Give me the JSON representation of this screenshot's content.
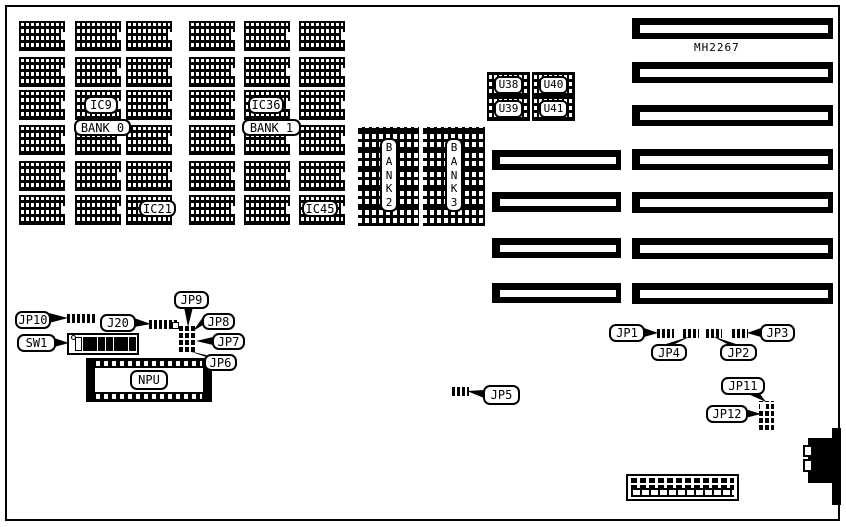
{
  "board": {
    "part_number": "MH2267",
    "chip_grid": {
      "cols": [
        19,
        75,
        126,
        189,
        244,
        299
      ],
      "rows": [
        21,
        57,
        90,
        125,
        161,
        195
      ],
      "chip_w": 46,
      "chip_h": 30
    },
    "chip_labels": [
      {
        "id": "ic9",
        "text": "IC9",
        "x": 84,
        "y": 96,
        "w": 34,
        "h": 18
      },
      {
        "id": "bank0",
        "text": "BANK 0",
        "x": 74,
        "y": 119,
        "w": 57,
        "h": 17
      },
      {
        "id": "ic36",
        "text": "IC36",
        "x": 248,
        "y": 96,
        "w": 36,
        "h": 18
      },
      {
        "id": "bank1",
        "text": "BANK 1",
        "x": 242,
        "y": 119,
        "w": 59,
        "h": 17
      },
      {
        "id": "ic21",
        "text": "IC21",
        "x": 139,
        "y": 200,
        "w": 37,
        "h": 17
      },
      {
        "id": "ic45",
        "text": "IC45",
        "x": 302,
        "y": 200,
        "w": 36,
        "h": 17
      }
    ],
    "simm_banks": [
      {
        "id": "bank2",
        "letters": "BANK2",
        "x": 358,
        "y": 127,
        "w": 61,
        "h": 99
      },
      {
        "id": "bank3",
        "letters": "BANK3",
        "x": 423,
        "y": 127,
        "w": 62,
        "h": 99
      }
    ],
    "u_chips": [
      {
        "id": "u38",
        "text": "U38",
        "x": 487,
        "y": 72,
        "w": 43,
        "h": 25
      },
      {
        "id": "u40",
        "text": "U40",
        "x": 532,
        "y": 72,
        "w": 43,
        "h": 25
      },
      {
        "id": "u39",
        "text": "U39",
        "x": 487,
        "y": 97,
        "w": 43,
        "h": 24
      },
      {
        "id": "u41",
        "text": "U41",
        "x": 532,
        "y": 97,
        "w": 43,
        "h": 24
      }
    ],
    "slots_short": {
      "x": 492,
      "w": 129,
      "h": 20,
      "ys": [
        150,
        192,
        238,
        283
      ]
    },
    "slots_long": {
      "x": 632,
      "w": 201,
      "h": 21,
      "ys": [
        18,
        62,
        105,
        149,
        192,
        238,
        283
      ]
    },
    "callouts": [
      {
        "id": "jp10",
        "text": "JP10",
        "x": 15,
        "y": 311,
        "w": 36,
        "h": 18
      },
      {
        "id": "j20",
        "text": "J20",
        "x": 100,
        "y": 314,
        "w": 36,
        "h": 18
      },
      {
        "id": "jp9",
        "text": "JP9",
        "x": 174,
        "y": 291,
        "w": 35,
        "h": 18
      },
      {
        "id": "jp8",
        "text": "JP8",
        "x": 202,
        "y": 313,
        "w": 33,
        "h": 17
      },
      {
        "id": "jp7",
        "text": "JP7",
        "x": 212,
        "y": 333,
        "w": 33,
        "h": 17
      },
      {
        "id": "jp6",
        "text": "JP6",
        "x": 204,
        "y": 354,
        "w": 33,
        "h": 17
      },
      {
        "id": "sw1",
        "text": "SW1",
        "x": 17,
        "y": 334,
        "w": 39,
        "h": 18
      },
      {
        "id": "jp5",
        "text": "JP5",
        "x": 483,
        "y": 385,
        "w": 37,
        "h": 20
      },
      {
        "id": "jp1",
        "text": "JP1",
        "x": 609,
        "y": 324,
        "w": 36,
        "h": 18
      },
      {
        "id": "jp4",
        "text": "JP4",
        "x": 651,
        "y": 344,
        "w": 36,
        "h": 17
      },
      {
        "id": "jp2",
        "text": "JP2",
        "x": 720,
        "y": 344,
        "w": 37,
        "h": 17
      },
      {
        "id": "jp3",
        "text": "JP3",
        "x": 760,
        "y": 324,
        "w": 35,
        "h": 18
      },
      {
        "id": "jp11",
        "text": "JP11",
        "x": 721,
        "y": 377,
        "w": 44,
        "h": 18
      },
      {
        "id": "jp12",
        "text": "JP12",
        "x": 706,
        "y": 405,
        "w": 42,
        "h": 18
      }
    ],
    "jumpers": [
      {
        "id": "jp10",
        "x": 67,
        "y": 314,
        "w": 28,
        "h": 9
      },
      {
        "id": "j20",
        "x": 149,
        "y": 320,
        "w": 29,
        "h": 9
      },
      {
        "id": "jp5",
        "x": 452,
        "y": 387,
        "w": 17,
        "h": 9
      },
      {
        "id": "jp1",
        "x": 657,
        "y": 329,
        "w": 17,
        "h": 9
      },
      {
        "id": "jp4",
        "x": 683,
        "y": 329,
        "w": 16,
        "h": 9
      },
      {
        "id": "jp2",
        "x": 706,
        "y": 329,
        "w": 16,
        "h": 9
      },
      {
        "id": "jp3",
        "x": 732,
        "y": 329,
        "w": 16,
        "h": 9
      }
    ],
    "pin_blocks": [
      {
        "id": "jp6-jp9",
        "x": 179,
        "y": 325,
        "w": 18,
        "h": 27,
        "tag": {
          "x": 172,
          "y": 322,
          "w": 7,
          "h": 7
        }
      },
      {
        "id": "jp11-jp12",
        "x": 759,
        "y": 401,
        "w": 15,
        "h": 29,
        "open_cell": {
          "x": 760,
          "y": 403,
          "w": 6,
          "h": 7
        }
      }
    ],
    "dip_switch": {
      "box": {
        "x": 67,
        "y": 333,
        "w": 72,
        "h": 22
      },
      "dot": {
        "x": 71,
        "y": 335,
        "w": 5,
        "h": 5
      },
      "count": 8,
      "x0": 75,
      "y0": 337,
      "pitch": 7.7,
      "sw_w": 7,
      "sw_h": 14
    },
    "npu": {
      "label": "NPU",
      "x": 86,
      "y": 358,
      "w": 126,
      "h": 44
    },
    "bottom_connector": {
      "x": 626,
      "y": 474,
      "w": 113,
      "h": 27
    },
    "keyboard": {
      "bar": {
        "x": 832,
        "y": 428,
        "w": 9,
        "h": 77
      },
      "body": {
        "x": 808,
        "y": 438,
        "w": 33,
        "h": 45
      },
      "notches": [
        {
          "x": 803,
          "y": 445,
          "w": 10,
          "h": 12
        },
        {
          "x": 803,
          "y": 459,
          "w": 10,
          "h": 13
        }
      ]
    },
    "tails": [
      {
        "for": "jp10",
        "points": "49,313 49,323 68,318"
      },
      {
        "for": "j20",
        "points": "134,318 134,327 151,324"
      },
      {
        "for": "sw1",
        "points": "54,338 54,347 69,343"
      },
      {
        "for": "jp9",
        "points": "184,307 193,307 188,327"
      },
      {
        "for": "jp8",
        "points": "203,317 203,325 193,331"
      },
      {
        "for": "jp7",
        "points": "213,337 213,345 196,341"
      },
      {
        "for": "jp6",
        "points": "206,355 212,359 189,351"
      },
      {
        "for": "jp5",
        "points": "484,390 484,398 467,391"
      },
      {
        "for": "jp1",
        "points": "644,328 644,337 658,333"
      },
      {
        "for": "jp4",
        "points": "663,345 673,345 691,336"
      },
      {
        "for": "jp2",
        "points": "729,345 739,345 712,336"
      },
      {
        "for": "jp3",
        "points": "761,328 761,337 747,333"
      },
      {
        "for": "jp11",
        "points": "748,394 757,390 766,402"
      },
      {
        "for": "jp12",
        "points": "745,409 745,418 761,414"
      }
    ]
  }
}
